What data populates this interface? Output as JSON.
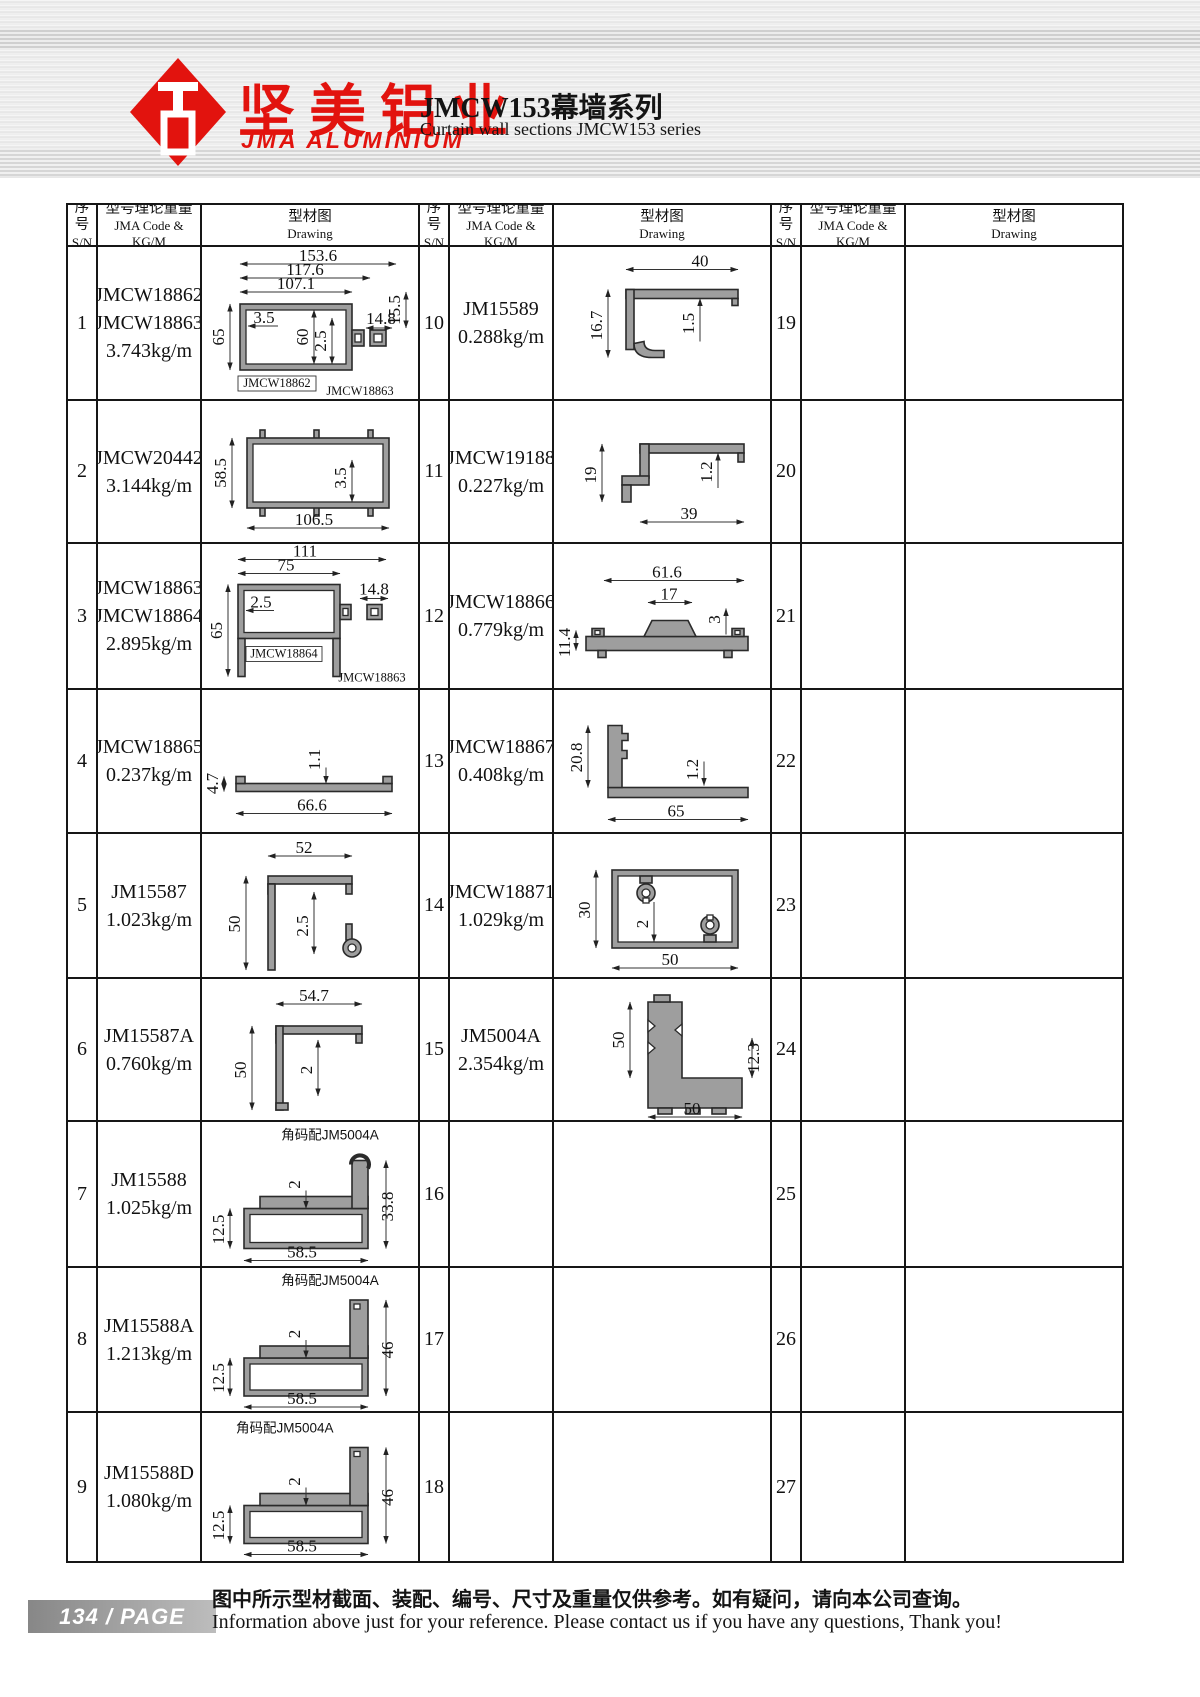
{
  "header": {
    "logo_cn": "坚美铝业",
    "logo_en": "JMA ALUMINIUM",
    "title_cn": "JMCW153幕墙系列",
    "title_en": "Curtain wall sections JMCW153 series"
  },
  "table": {
    "h_sn_cn": "序号",
    "h_sn_en": "S/N",
    "h_code_cn": "型号理论重量",
    "h_code_en": "JMA Code & KG/M",
    "h_draw_cn": "型材图",
    "h_draw_en": "Drawing"
  },
  "rows": [
    {
      "sn": "1",
      "codes": [
        "JMCW18862",
        "JMCW18863"
      ],
      "weight": "3.743kg/m"
    },
    {
      "sn": "2",
      "codes": [
        "JMCW20442"
      ],
      "weight": "3.144kg/m"
    },
    {
      "sn": "3",
      "codes": [
        "JMCW18863",
        "JMCW18864"
      ],
      "weight": "2.895kg/m"
    },
    {
      "sn": "4",
      "codes": [
        "JMCW18865"
      ],
      "weight": "0.237kg/m"
    },
    {
      "sn": "5",
      "codes": [
        "JM15587"
      ],
      "weight": "1.023kg/m"
    },
    {
      "sn": "6",
      "codes": [
        "JM15587A"
      ],
      "weight": "0.760kg/m"
    },
    {
      "sn": "7",
      "codes": [
        "JM15588"
      ],
      "weight": "1.025kg/m"
    },
    {
      "sn": "8",
      "codes": [
        "JM15588A"
      ],
      "weight": "1.213kg/m"
    },
    {
      "sn": "9",
      "codes": [
        "JM15588D"
      ],
      "weight": "1.080kg/m"
    },
    {
      "sn": "10",
      "codes": [
        "JM15589"
      ],
      "weight": "0.288kg/m"
    },
    {
      "sn": "11",
      "codes": [
        "JMCW19188"
      ],
      "weight": "0.227kg/m"
    },
    {
      "sn": "12",
      "codes": [
        "JMCW18866"
      ],
      "weight": "0.779kg/m"
    },
    {
      "sn": "13",
      "codes": [
        "JMCW18867"
      ],
      "weight": "0.408kg/m"
    },
    {
      "sn": "14",
      "codes": [
        "JMCW18871"
      ],
      "weight": "1.029kg/m"
    },
    {
      "sn": "15",
      "codes": [
        "JM5004A"
      ],
      "weight": "2.354kg/m"
    },
    {
      "sn": "16"
    },
    {
      "sn": "17"
    },
    {
      "sn": "18"
    },
    {
      "sn": "19"
    },
    {
      "sn": "20"
    },
    {
      "sn": "21"
    },
    {
      "sn": "22"
    },
    {
      "sn": "23"
    },
    {
      "sn": "24"
    },
    {
      "sn": "25"
    },
    {
      "sn": "26"
    },
    {
      "sn": "27"
    }
  ],
  "drawings": {
    "d1": {
      "a": "153.6",
      "b": "117.6",
      "c": "107.1",
      "d": "3.5",
      "e": "65",
      "f": "60",
      "g": "2.5",
      "h": "14.8",
      "i": "15.5",
      "l1": "JMCW18862",
      "l2": "JMCW18863"
    },
    "d2": {
      "a": "58.5",
      "b": "3.5",
      "c": "106.5"
    },
    "d3": {
      "a": "111",
      "b": "75",
      "c": "2.5",
      "d": "65",
      "e": "14.8",
      "l1": "JMCW18864",
      "l2": "JMCW18863"
    },
    "d4": {
      "a": "4.7",
      "b": "1.1",
      "c": "66.6"
    },
    "d5": {
      "a": "52",
      "b": "50",
      "c": "2.5"
    },
    "d6": {
      "a": "54.7",
      "b": "50",
      "c": "2"
    },
    "d7": {
      "lbl": "角码配JM5004A",
      "a": "2",
      "b": "33.8",
      "c": "12.5",
      "d": "58.5"
    },
    "d8": {
      "lbl": "角码配JM5004A",
      "a": "2",
      "b": "46",
      "c": "12.5",
      "d": "58.5"
    },
    "d9": {
      "lbl": "角码配JM5004A",
      "a": "2",
      "b": "46",
      "c": "12.5",
      "d": "58.5"
    },
    "d10": {
      "a": "40",
      "b": "16.7",
      "c": "1.5"
    },
    "d11": {
      "a": "19",
      "b": "1.2",
      "c": "39"
    },
    "d12": {
      "a": "61.6",
      "b": "17",
      "c": "3",
      "d": "11.4"
    },
    "d13": {
      "a": "20.8",
      "b": "1.2",
      "c": "65"
    },
    "d14": {
      "a": "30",
      "b": "2",
      "c": "50"
    },
    "d15": {
      "a": "50",
      "b": "12.3",
      "c": "50"
    }
  },
  "footer": {
    "page": "134  /  PAGE",
    "note_cn": "图中所示型材截面、装配、编号、尺寸及重量仅供参考。如有疑问，请向本公司查询。",
    "note_en": "Information above just for your reference. Please contact us if you have any questions, Thank you!"
  }
}
